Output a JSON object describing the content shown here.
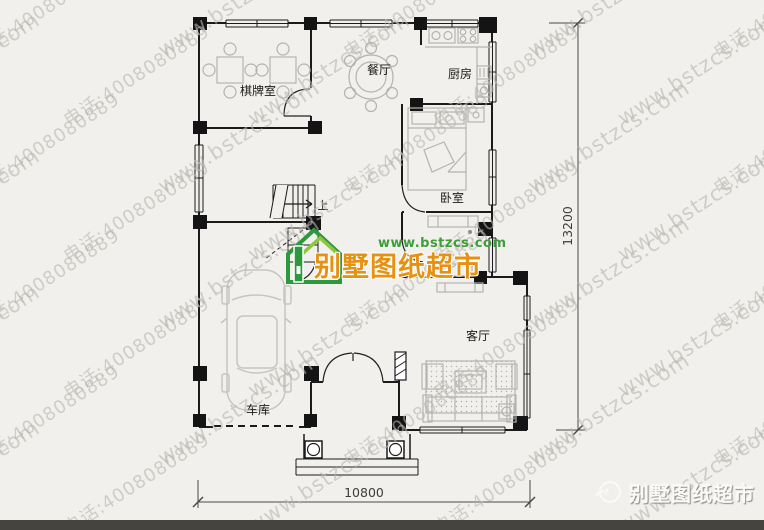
{
  "page": {
    "background": "#f1f0ed",
    "bottom_bar_color": "#45443f"
  },
  "watermark": {
    "url_text": "www.bstzcs.com",
    "phone_text": "电话:4008080889",
    "color": "#b9b6b1"
  },
  "plan": {
    "rooms": {
      "chess": {
        "label": "棋牌室"
      },
      "dining": {
        "label": "餐厅"
      },
      "kitchen": {
        "label": "厨房"
      },
      "bedroom": {
        "label": "卧室"
      },
      "living": {
        "label": "客厅"
      },
      "garage": {
        "label": "车库"
      }
    },
    "stairs": {
      "up_label": "上"
    },
    "dimensions": {
      "width": "10800",
      "height": "13200"
    }
  },
  "brand_center": {
    "website": "www.bstzcs.com",
    "name": "别墅图纸超市",
    "name_color": "#e59112",
    "website_color": "#3f9d3c",
    "logo_green_dark": "#2c9a3c",
    "logo_green_light": "#8dc63f"
  },
  "brand_footer": {
    "name": "别墅图纸超市"
  }
}
